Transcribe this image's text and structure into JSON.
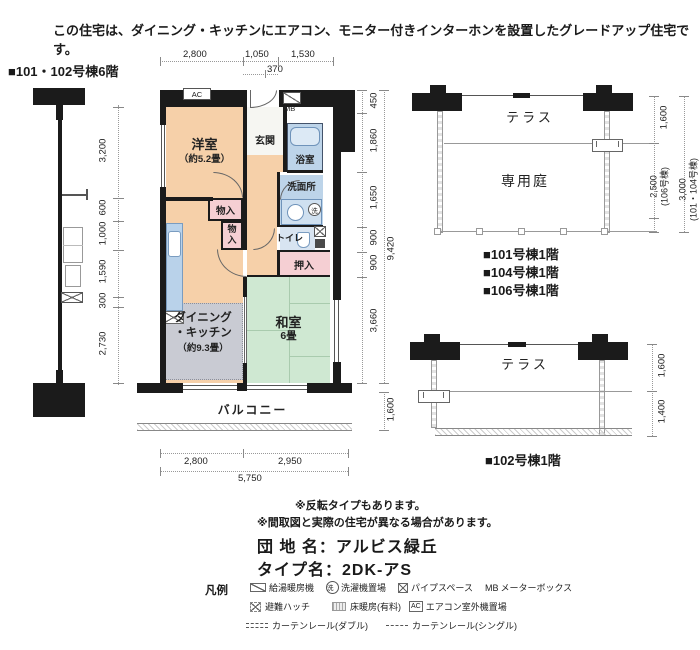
{
  "header": {
    "notice": "この住宅は、ダイニング・キッチンにエアコン、モニター付きインターホンを設置したグレードアップ住宅です。"
  },
  "plan": {
    "title": "■101・102号棟6階",
    "rooms": {
      "western": {
        "name": "洋室",
        "size": "（約5.2畳）"
      },
      "entrance": "玄関",
      "bath": "浴室",
      "washroom": "洗面所",
      "toilet": "トイレ",
      "closet_upper": "物入",
      "closet_lower": "物入",
      "oshiire": "押入",
      "dk": {
        "line1": "ダイニング",
        "line2": "・キッチン",
        "size": "（約9.3畳）"
      },
      "tatami": {
        "name": "和室",
        "size": "6畳"
      },
      "balcony": "バルコニー"
    },
    "fixtures": {
      "ac": "AC",
      "mb": "MB",
      "wash_machine": "洗"
    },
    "dims": {
      "top": [
        "2,800",
        "1,050",
        "1,530"
      ],
      "top_sub": "370",
      "left": [
        "3,200",
        "600",
        "1,000",
        "1,590",
        "300",
        "2,730"
      ],
      "right": [
        "450",
        "1,860",
        "1,650",
        "900",
        "900",
        "3,660"
      ],
      "right_total": "9,420",
      "balcony_depth": "1,600",
      "bottom": [
        "2,800",
        "2,950"
      ],
      "bottom_total": "5,750"
    }
  },
  "site_upper": {
    "terrace": "テラス",
    "garden": "専用庭",
    "dims": {
      "terrace_depth": "1,600",
      "garden_106": {
        "value": "2,500",
        "note": "(106号棟)"
      },
      "garden_101_104": {
        "value": "3,000",
        "note": "(101・104号棟)"
      }
    },
    "buildings": [
      "■101号棟1階",
      "■104号棟1階",
      "■106号棟1階"
    ]
  },
  "site_lower": {
    "terrace": "テラス",
    "dims": {
      "terrace_depth": "1,600",
      "front": "1,400"
    },
    "building": "■102号棟1階"
  },
  "notes": [
    "※反転タイプもあります。",
    "※間取図と実際の住宅が異なる場合があります。"
  ],
  "estate": {
    "danchi": "団 地 名：アルビス緑丘",
    "type": "タイプ名：2DK-アS"
  },
  "legend": {
    "title": "凡例",
    "items": {
      "boiler": "給湯暖房機",
      "washer": "洗濯機置場",
      "washer_symbol": "洗",
      "pipe": "パイプスペース",
      "mb_prefix": "MB",
      "mb": "メーターボックス",
      "hatch": "避難ハッチ",
      "floor_heating": "床暖房(有料)",
      "ac_prefix": "AC",
      "ac_outdoor": "エアコン室外機置場",
      "curtain_double": "カーテンレール(ダブル)",
      "curtain_single": "カーテンレール(シングル)"
    }
  },
  "colors": {
    "room_peach": "#f6d0a9",
    "wet_blue": "#bdd4e9",
    "fixture_blue": "#cfe0f0",
    "tatami_green": "#cfe8d2",
    "closet_pink": "#f5cfd3",
    "heating_gray": "#c9cbd3",
    "wall": "#1b1b1b"
  }
}
